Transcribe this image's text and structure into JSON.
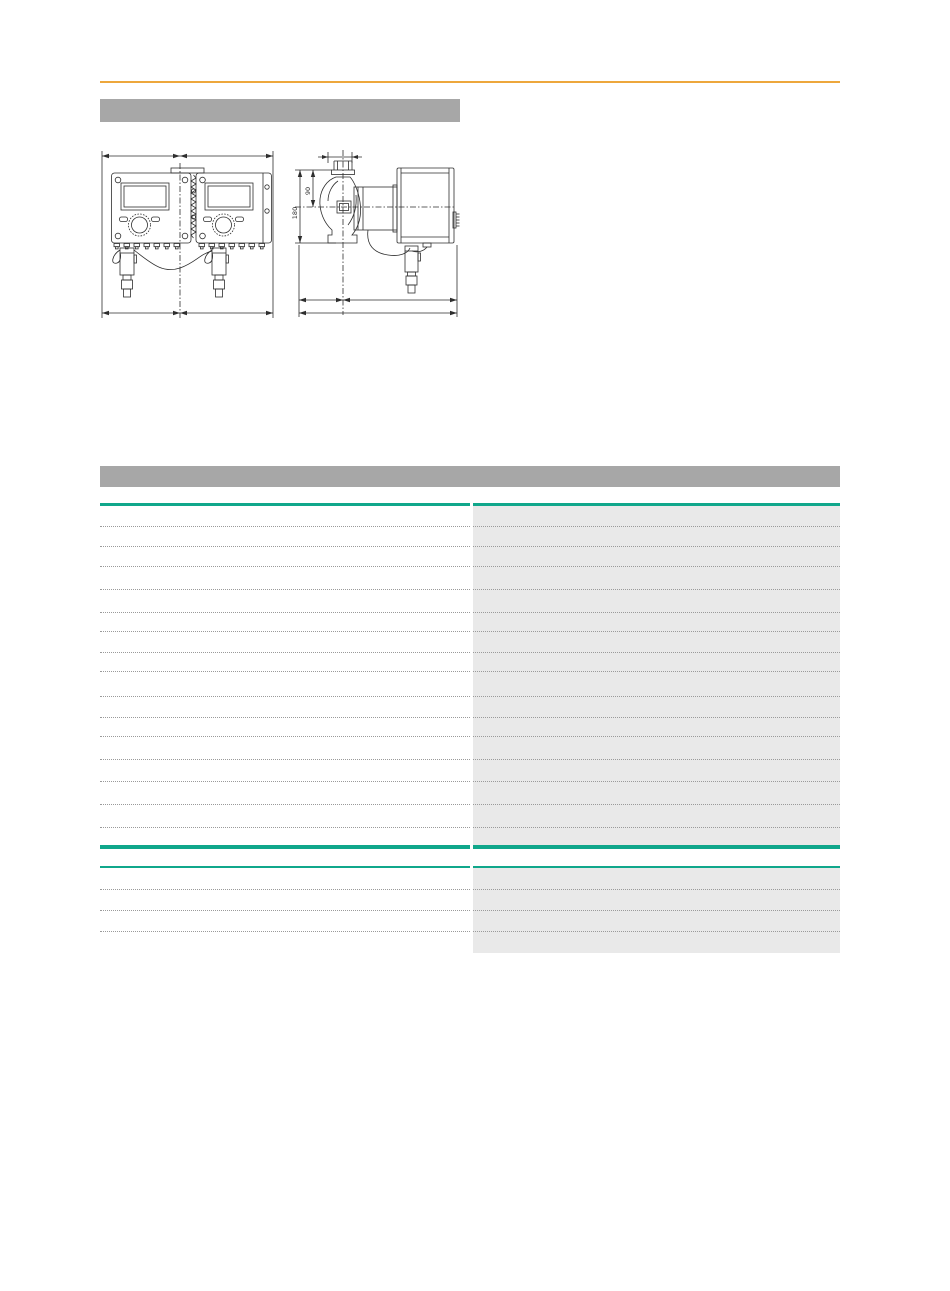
{
  "page": {
    "background": "#ffffff"
  },
  "top_rule": {
    "color": "#EDA73C"
  },
  "title_bar": {
    "label": "",
    "color": "#A7A7A7"
  },
  "section_header": {
    "label": "",
    "color": "#A7A7A7"
  },
  "drawings": {
    "side_view": {
      "dim_total_label": "180",
      "dim_center_label": "90"
    }
  },
  "spec_table": {
    "accent_color": "#10A78B",
    "right_column_color": "#E9E9E9",
    "separator_color": "#9A9A9A",
    "section1": {
      "row_heights": [
        21,
        20,
        20,
        23,
        23,
        19,
        21,
        19,
        25,
        21,
        19,
        23,
        22,
        23,
        23,
        17
      ]
    },
    "section2": {
      "row_heights": [
        22,
        21,
        21
      ],
      "right_extra_height": 21
    }
  }
}
